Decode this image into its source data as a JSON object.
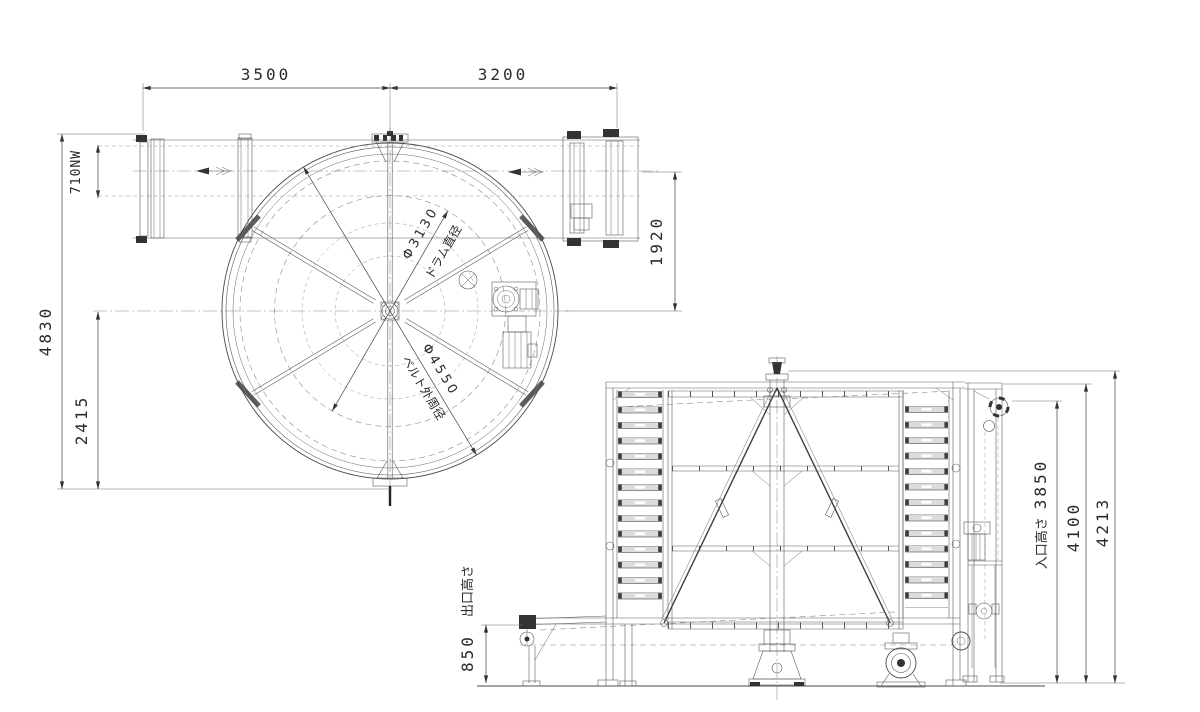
{
  "drawing": {
    "plan_view": {
      "dim_span_left": "3500",
      "dim_span_right": "3200",
      "dim_belt_width": "710NW",
      "dim_overall_height": "4830",
      "dim_center_height": "2415",
      "dim_conveyor_offset": "1920",
      "drum_diameter": "Φ3130",
      "drum_diameter_caption": "ドラム直径",
      "belt_outer_diameter": "Φ4550",
      "belt_outer_caption": "ベルト外周径"
    },
    "elevation_view": {
      "inlet_height_label": "入口高さ",
      "inlet_height_value": "3850",
      "dim_frame_height": "4100",
      "dim_overall_height": "4213",
      "outlet_height_label": "出口高さ",
      "outlet_height_value": "850"
    },
    "colors": {
      "line": "#4a4a4a",
      "background": "#ffffff"
    }
  }
}
